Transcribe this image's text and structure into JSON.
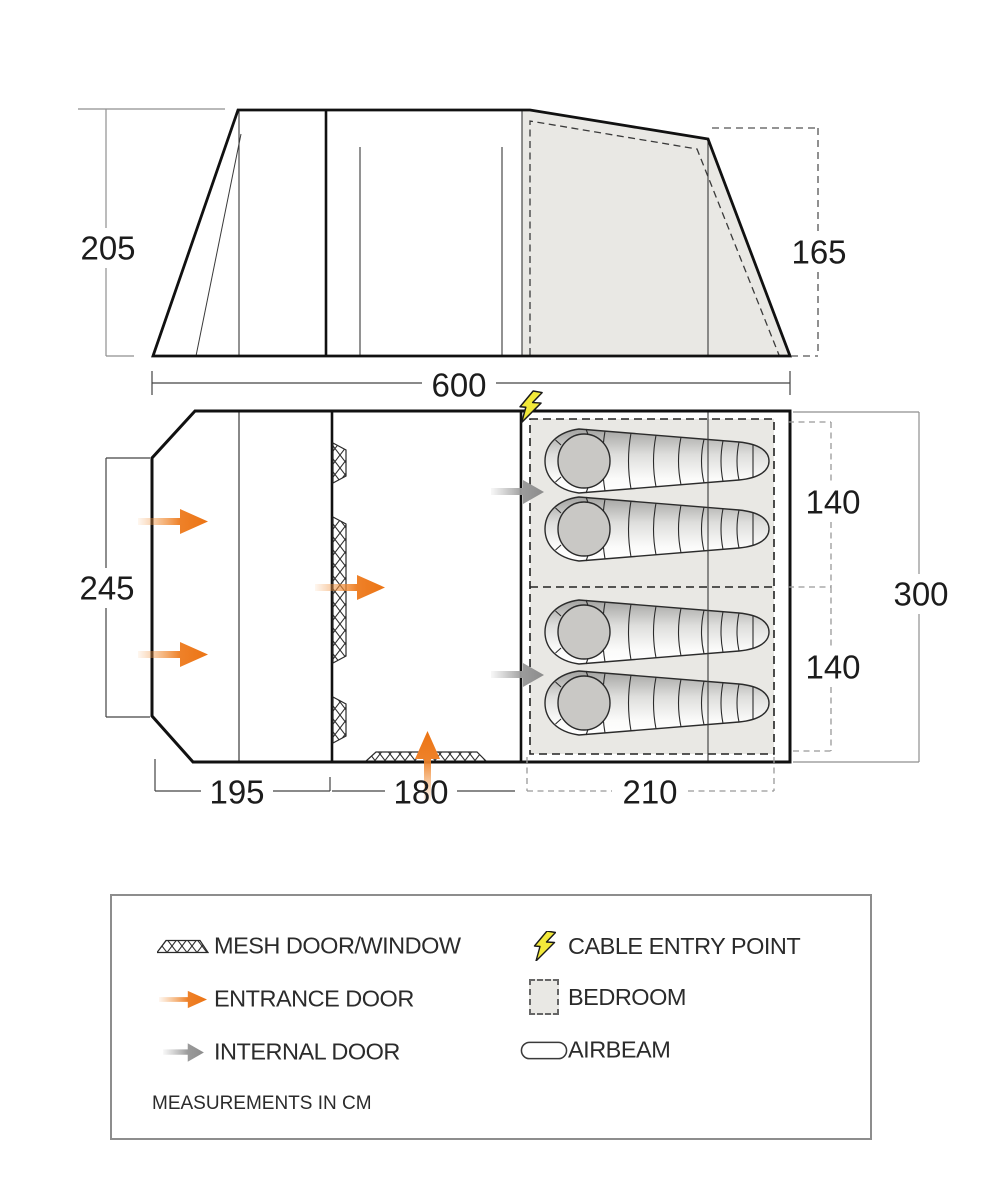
{
  "dimensions": {
    "front_height": "205",
    "rear_height": "165",
    "total_length": "600",
    "front_width": "245",
    "total_width": "300",
    "bedroom_upper": "140",
    "bedroom_lower": "140",
    "porch_section": "195",
    "living_section": "180",
    "bedroom_section": "210"
  },
  "legend": {
    "items": [
      {
        "id": "mesh-door-window",
        "label": "MESH DOOR/WINDOW"
      },
      {
        "id": "entrance-door",
        "label": "ENTRANCE DOOR"
      },
      {
        "id": "internal-door",
        "label": "INTERNAL DOOR"
      },
      {
        "id": "cable-entry-point",
        "label": "CABLE ENTRY POINT"
      },
      {
        "id": "bedroom",
        "label": "BEDROOM"
      },
      {
        "id": "airbeam",
        "label": "AIRBEAM"
      }
    ],
    "note": "MEASUREMENTS IN CM"
  },
  "colors": {
    "accent_orange": "#ed7d1f",
    "arrow_gray": "#979797",
    "bolt_yellow": "#f2e93a",
    "bedroom_fill": "#e9e8e4",
    "outline": "#111111"
  }
}
